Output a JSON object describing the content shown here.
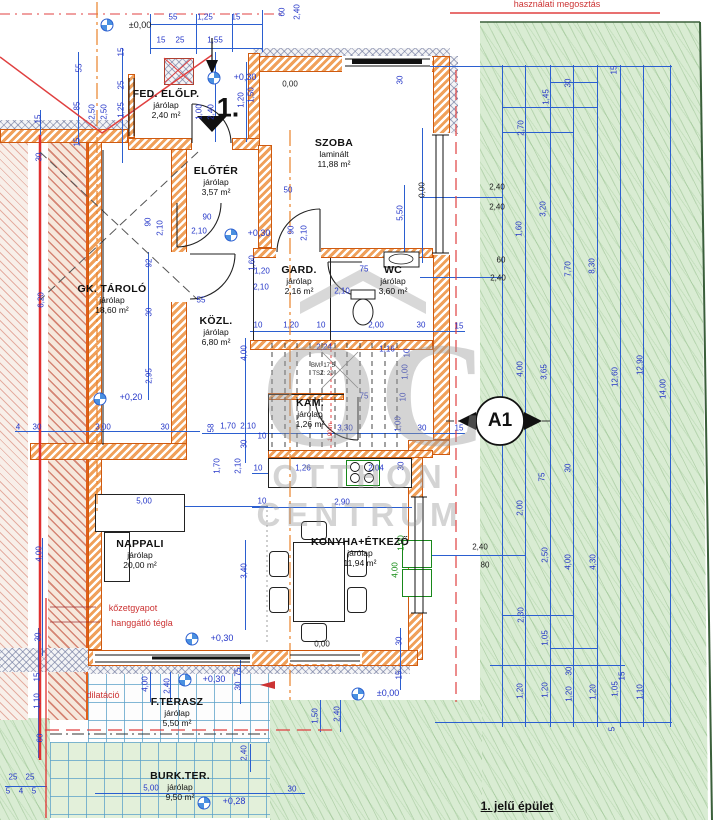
{
  "top_note": "használati megosztás",
  "building_label": "1. jelű épület",
  "entrance_no": "1.",
  "section_marker": "A1",
  "stair_note1": "BM: 17,5",
  "stair_note2": "TSZ: 29",
  "red_notes": {
    "insulation": "kőzetgyapot",
    "brick": "hanggátló tégla",
    "dilatation": "dilatáció"
  },
  "watermark": {
    "logo": "OC",
    "line1": "OTTHON",
    "line2": "CENTRUM"
  },
  "colors": {
    "dim_blue": "#2335c8",
    "wall_orange": "#cf5a10",
    "garden_green": "#d9ecd3",
    "red_line": "#e04040"
  },
  "rooms": [
    {
      "name": "FED. ELŐLP.",
      "finish": "járólap",
      "area": "2,40 m²"
    },
    {
      "name": "ELŐTÉR",
      "finish": "járólap",
      "area": "3,57 m²"
    },
    {
      "name": "SZOBA",
      "finish": "laminált",
      "area": "11,88 m²"
    },
    {
      "name": "GK. TÁROLÓ",
      "finish": "járólap",
      "area": "18,60 m²"
    },
    {
      "name": "KÖZL.",
      "finish": "járólap",
      "area": "6,80 m²"
    },
    {
      "name": "GARD.",
      "finish": "járólap",
      "area": "2,16 m²"
    },
    {
      "name": "WC",
      "finish": "járólap",
      "area": "3,60 m²"
    },
    {
      "name": "KAM.",
      "finish": "járólap",
      "area": "1,26 m²"
    },
    {
      "name": "NAPPALI",
      "finish": "járólap",
      "area": "20,00 m²"
    },
    {
      "name": "KONYHA+ÉTKEZŐ",
      "finish": "járólap",
      "area": "11,94 m²"
    },
    {
      "name": "F.TERASZ",
      "finish": "járólap",
      "area": "5,50 m²"
    },
    {
      "name": "BURK.TER.",
      "finish": "járólap",
      "area": "9,50 m²"
    }
  ],
  "levels": [
    {
      "label": "±0,00",
      "mx": 107,
      "my": 25,
      "lx": 140,
      "ly": 25,
      "c": "k"
    },
    {
      "label": "+0,30",
      "mx": 214,
      "my": 78,
      "lx": 245,
      "ly": 77
    },
    {
      "label": "+0,30",
      "mx": 231,
      "my": 235,
      "lx": 259,
      "ly": 233
    },
    {
      "label": "+0,20",
      "mx": 100,
      "my": 399,
      "lx": 131,
      "ly": 397
    },
    {
      "label": "+0,30",
      "mx": 192,
      "my": 639,
      "lx": 222,
      "ly": 638
    },
    {
      "label": "+0,30",
      "mx": 185,
      "my": 680,
      "lx": 214,
      "ly": 679
    },
    {
      "label": "±0,00",
      "mx": 358,
      "my": 694,
      "lx": 388,
      "ly": 693
    },
    {
      "label": "+0,28",
      "mx": 204,
      "my": 803,
      "lx": 234,
      "ly": 801
    }
  ],
  "dims": [
    {
      "t": "55",
      "x": 173,
      "y": 17
    },
    {
      "t": "1,25",
      "x": 205,
      "y": 17
    },
    {
      "t": "15",
      "x": 236,
      "y": 17
    },
    {
      "t": "15",
      "x": 161,
      "y": 40
    },
    {
      "t": "25",
      "x": 180,
      "y": 40
    },
    {
      "t": "1,55",
      "x": 215,
      "y": 40
    },
    {
      "t": "60",
      "x": 282,
      "y": 12,
      "r": 1
    },
    {
      "t": "2,40",
      "x": 297,
      "y": 12,
      "r": 1
    },
    {
      "t": "15",
      "x": 121,
      "y": 52,
      "r": 1
    },
    {
      "t": "55",
      "x": 79,
      "y": 68,
      "r": 1
    },
    {
      "t": "25",
      "x": 121,
      "y": 85,
      "r": 1
    },
    {
      "t": "85",
      "x": 77,
      "y": 106,
      "r": 1
    },
    {
      "t": "1,25",
      "x": 121,
      "y": 110,
      "r": 1
    },
    {
      "t": "2,50",
      "x": 92,
      "y": 112,
      "r": 1
    },
    {
      "t": "2,50",
      "x": 104,
      "y": 112,
      "r": 1
    },
    {
      "t": "15",
      "x": 38,
      "y": 119,
      "r": 1
    },
    {
      "t": "15",
      "x": 77,
      "y": 142,
      "r": 1
    },
    {
      "t": "30",
      "x": 39,
      "y": 157,
      "r": 1
    },
    {
      "t": "0,00",
      "x": 290,
      "y": 84,
      "c": "k"
    },
    {
      "t": "1,50",
      "x": 251,
      "y": 95,
      "r": 1
    },
    {
      "t": "1,20",
      "x": 241,
      "y": 100,
      "r": 1
    },
    {
      "t": "1,00",
      "x": 199,
      "y": 112,
      "r": 1
    },
    {
      "t": "2,40",
      "x": 211,
      "y": 112,
      "r": 1
    },
    {
      "t": "30",
      "x": 400,
      "y": 80,
      "r": 1
    },
    {
      "t": "50",
      "x": 288,
      "y": 190
    },
    {
      "t": "90",
      "x": 291,
      "y": 230,
      "r": 1
    },
    {
      "t": "2,10",
      "x": 304,
      "y": 233,
      "r": 1
    },
    {
      "t": "5,50",
      "x": 400,
      "y": 213,
      "r": 1
    },
    {
      "t": "0,00",
      "x": 422,
      "y": 190,
      "r": 1,
      "c": "k"
    },
    {
      "t": "6,20",
      "x": 41,
      "y": 300,
      "r": 1
    },
    {
      "t": "92",
      "x": 149,
      "y": 263,
      "r": 1
    },
    {
      "t": "30",
      "x": 149,
      "y": 312,
      "r": 1
    },
    {
      "t": "2,95",
      "x": 149,
      "y": 376,
      "r": 1
    },
    {
      "t": "4",
      "x": 18,
      "y": 427
    },
    {
      "t": "30",
      "x": 37,
      "y": 427
    },
    {
      "t": "3,00",
      "x": 103,
      "y": 427
    },
    {
      "t": "30",
      "x": 165,
      "y": 427
    },
    {
      "t": "55",
      "x": 201,
      "y": 300
    },
    {
      "t": "90",
      "x": 207,
      "y": 217
    },
    {
      "t": "2,10",
      "x": 199,
      "y": 231
    },
    {
      "t": "90",
      "x": 148,
      "y": 222,
      "r": 1
    },
    {
      "t": "2,10",
      "x": 160,
      "y": 228,
      "r": 1
    },
    {
      "t": "1,60",
      "x": 252,
      "y": 263,
      "r": 1
    },
    {
      "t": "1,20",
      "x": 262,
      "y": 271
    },
    {
      "t": "2,10",
      "x": 261,
      "y": 287
    },
    {
      "t": "75",
      "x": 364,
      "y": 269
    },
    {
      "t": "2,10",
      "x": 342,
      "y": 291
    },
    {
      "t": "10",
      "x": 258,
      "y": 325
    },
    {
      "t": "1,20",
      "x": 291,
      "y": 325
    },
    {
      "t": "10",
      "x": 321,
      "y": 325
    },
    {
      "t": "2,00",
      "x": 376,
      "y": 325
    },
    {
      "t": "30",
      "x": 421,
      "y": 325
    },
    {
      "t": "15",
      "x": 459,
      "y": 326
    },
    {
      "t": "4,00",
      "x": 244,
      "y": 353,
      "r": 1
    },
    {
      "t": "2,24",
      "x": 324,
      "y": 347
    },
    {
      "t": "1,16",
      "x": 387,
      "y": 349
    },
    {
      "t": "10",
      "x": 407,
      "y": 353,
      "r": 1
    },
    {
      "t": "1,00",
      "x": 405,
      "y": 372,
      "r": 1
    },
    {
      "t": "10",
      "x": 403,
      "y": 397,
      "r": 1
    },
    {
      "t": "1,00",
      "x": 398,
      "y": 424,
      "r": 1
    },
    {
      "t": "3,30",
      "x": 345,
      "y": 428
    },
    {
      "t": "30",
      "x": 422,
      "y": 428
    },
    {
      "t": "15",
      "x": 459,
      "y": 428
    },
    {
      "t": "1,90 m",
      "x": 331,
      "y": 432,
      "r": 1,
      "c": "rd",
      "s": 6
    },
    {
      "t": "58",
      "x": 211,
      "y": 428,
      "r": 1
    },
    {
      "t": "1,70",
      "x": 228,
      "y": 426
    },
    {
      "t": "2,10",
      "x": 248,
      "y": 426
    },
    {
      "t": "10",
      "x": 262,
      "y": 436
    },
    {
      "t": "30",
      "x": 244,
      "y": 444,
      "r": 1
    },
    {
      "t": "1,70",
      "x": 217,
      "y": 466,
      "r": 1
    },
    {
      "t": "2,10",
      "x": 238,
      "y": 466,
      "r": 1
    },
    {
      "t": "75",
      "x": 364,
      "y": 396
    },
    {
      "t": "5,00",
      "x": 144,
      "y": 501
    },
    {
      "t": "10",
      "x": 262,
      "y": 501
    },
    {
      "t": "2,90",
      "x": 342,
      "y": 502
    },
    {
      "t": "4,00",
      "x": 39,
      "y": 554,
      "r": 1
    },
    {
      "t": "3,40",
      "x": 244,
      "y": 571,
      "r": 1
    },
    {
      "t": "30",
      "x": 38,
      "y": 637,
      "r": 1
    },
    {
      "t": "10",
      "x": 258,
      "y": 468
    },
    {
      "t": "1,26",
      "x": 303,
      "y": 468
    },
    {
      "t": "2,04",
      "x": 376,
      "y": 468
    },
    {
      "t": "30",
      "x": 401,
      "y": 466,
      "r": 1
    },
    {
      "t": "30",
      "x": 399,
      "y": 641,
      "r": 1
    },
    {
      "t": "0,00",
      "x": 322,
      "y": 644,
      "c": "k"
    },
    {
      "t": "4,00",
      "x": 395,
      "y": 570,
      "r": 1,
      "c": "g"
    },
    {
      "t": "1,00",
      "x": 401,
      "y": 543,
      "r": 1,
      "c": "g"
    },
    {
      "t": "75",
      "x": 238,
      "y": 672,
      "r": 1
    },
    {
      "t": "30",
      "x": 238,
      "y": 686,
      "r": 1
    },
    {
      "t": "15",
      "x": 399,
      "y": 675,
      "r": 1
    },
    {
      "t": "4,00",
      "x": 145,
      "y": 684,
      "r": 1
    },
    {
      "t": "2,40",
      "x": 167,
      "y": 686,
      "r": 1
    },
    {
      "t": "1,50",
      "x": 315,
      "y": 716,
      "r": 1
    },
    {
      "t": "2,40",
      "x": 337,
      "y": 714,
      "r": 1
    },
    {
      "t": "15",
      "x": 37,
      "y": 677,
      "r": 1
    },
    {
      "t": "1,10",
      "x": 37,
      "y": 701,
      "r": 1
    },
    {
      "t": "60",
      "x": 40,
      "y": 738,
      "r": 1
    },
    {
      "t": "2,40",
      "x": 244,
      "y": 753,
      "r": 1
    },
    {
      "t": "25",
      "x": 13,
      "y": 777
    },
    {
      "t": "25",
      "x": 30,
      "y": 777
    },
    {
      "t": "5",
      "x": 8,
      "y": 791
    },
    {
      "t": "4",
      "x": 21,
      "y": 791
    },
    {
      "t": "5",
      "x": 34,
      "y": 791
    },
    {
      "t": "5,00",
      "x": 151,
      "y": 788
    },
    {
      "t": "30",
      "x": 292,
      "y": 789
    },
    {
      "t": "15",
      "x": 614,
      "y": 70,
      "r": 1
    },
    {
      "t": "30",
      "x": 568,
      "y": 83,
      "r": 1
    },
    {
      "t": "1,45",
      "x": 546,
      "y": 97,
      "r": 1
    },
    {
      "t": "2,70",
      "x": 521,
      "y": 128,
      "r": 1
    },
    {
      "t": "3,20",
      "x": 543,
      "y": 209,
      "r": 1
    },
    {
      "t": "1,60",
      "x": 519,
      "y": 229,
      "r": 1
    },
    {
      "t": "7,70",
      "x": 568,
      "y": 269,
      "r": 1
    },
    {
      "t": "8,30",
      "x": 592,
      "y": 266,
      "r": 1
    },
    {
      "t": "4,00",
      "x": 520,
      "y": 369,
      "r": 1
    },
    {
      "t": "3,65",
      "x": 544,
      "y": 372,
      "r": 1
    },
    {
      "t": "12,60",
      "x": 615,
      "y": 377,
      "r": 1
    },
    {
      "t": "12,90",
      "x": 640,
      "y": 365,
      "r": 1
    },
    {
      "t": "14,00",
      "x": 663,
      "y": 389,
      "r": 1
    },
    {
      "t": "75",
      "x": 542,
      "y": 477,
      "r": 1
    },
    {
      "t": "30",
      "x": 568,
      "y": 468,
      "r": 1
    },
    {
      "t": "2,00",
      "x": 520,
      "y": 508,
      "r": 1
    },
    {
      "t": "2,50",
      "x": 545,
      "y": 555,
      "r": 1
    },
    {
      "t": "4,00",
      "x": 568,
      "y": 562,
      "r": 1
    },
    {
      "t": "4,30",
      "x": 593,
      "y": 562,
      "r": 1
    },
    {
      "t": "2,30",
      "x": 521,
      "y": 615,
      "r": 1
    },
    {
      "t": "1,05",
      "x": 545,
      "y": 638,
      "r": 1
    },
    {
      "t": "30",
      "x": 569,
      "y": 671,
      "r": 1
    },
    {
      "t": "1,20",
      "x": 520,
      "y": 691,
      "r": 1
    },
    {
      "t": "1,20",
      "x": 545,
      "y": 690,
      "r": 1
    },
    {
      "t": "1,20",
      "x": 569,
      "y": 694,
      "r": 1
    },
    {
      "t": "1,20",
      "x": 593,
      "y": 692,
      "r": 1
    },
    {
      "t": "1,05",
      "x": 615,
      "y": 689,
      "r": 1
    },
    {
      "t": "15",
      "x": 622,
      "y": 676,
      "r": 1
    },
    {
      "t": "1,10",
      "x": 640,
      "y": 692,
      "r": 1
    },
    {
      "t": "5",
      "x": 612,
      "y": 729,
      "r": 1
    },
    {
      "t": "2,40",
      "x": 497,
      "y": 187,
      "c": "k"
    },
    {
      "t": "2,40",
      "x": 497,
      "y": 207,
      "c": "k"
    },
    {
      "t": "60",
      "x": 501,
      "y": 260,
      "c": "k"
    },
    {
      "t": "2,40",
      "x": 498,
      "y": 278,
      "c": "k"
    },
    {
      "t": "2,40",
      "x": 480,
      "y": 547,
      "c": "k"
    },
    {
      "t": "80",
      "x": 485,
      "y": 565,
      "c": "k"
    }
  ]
}
